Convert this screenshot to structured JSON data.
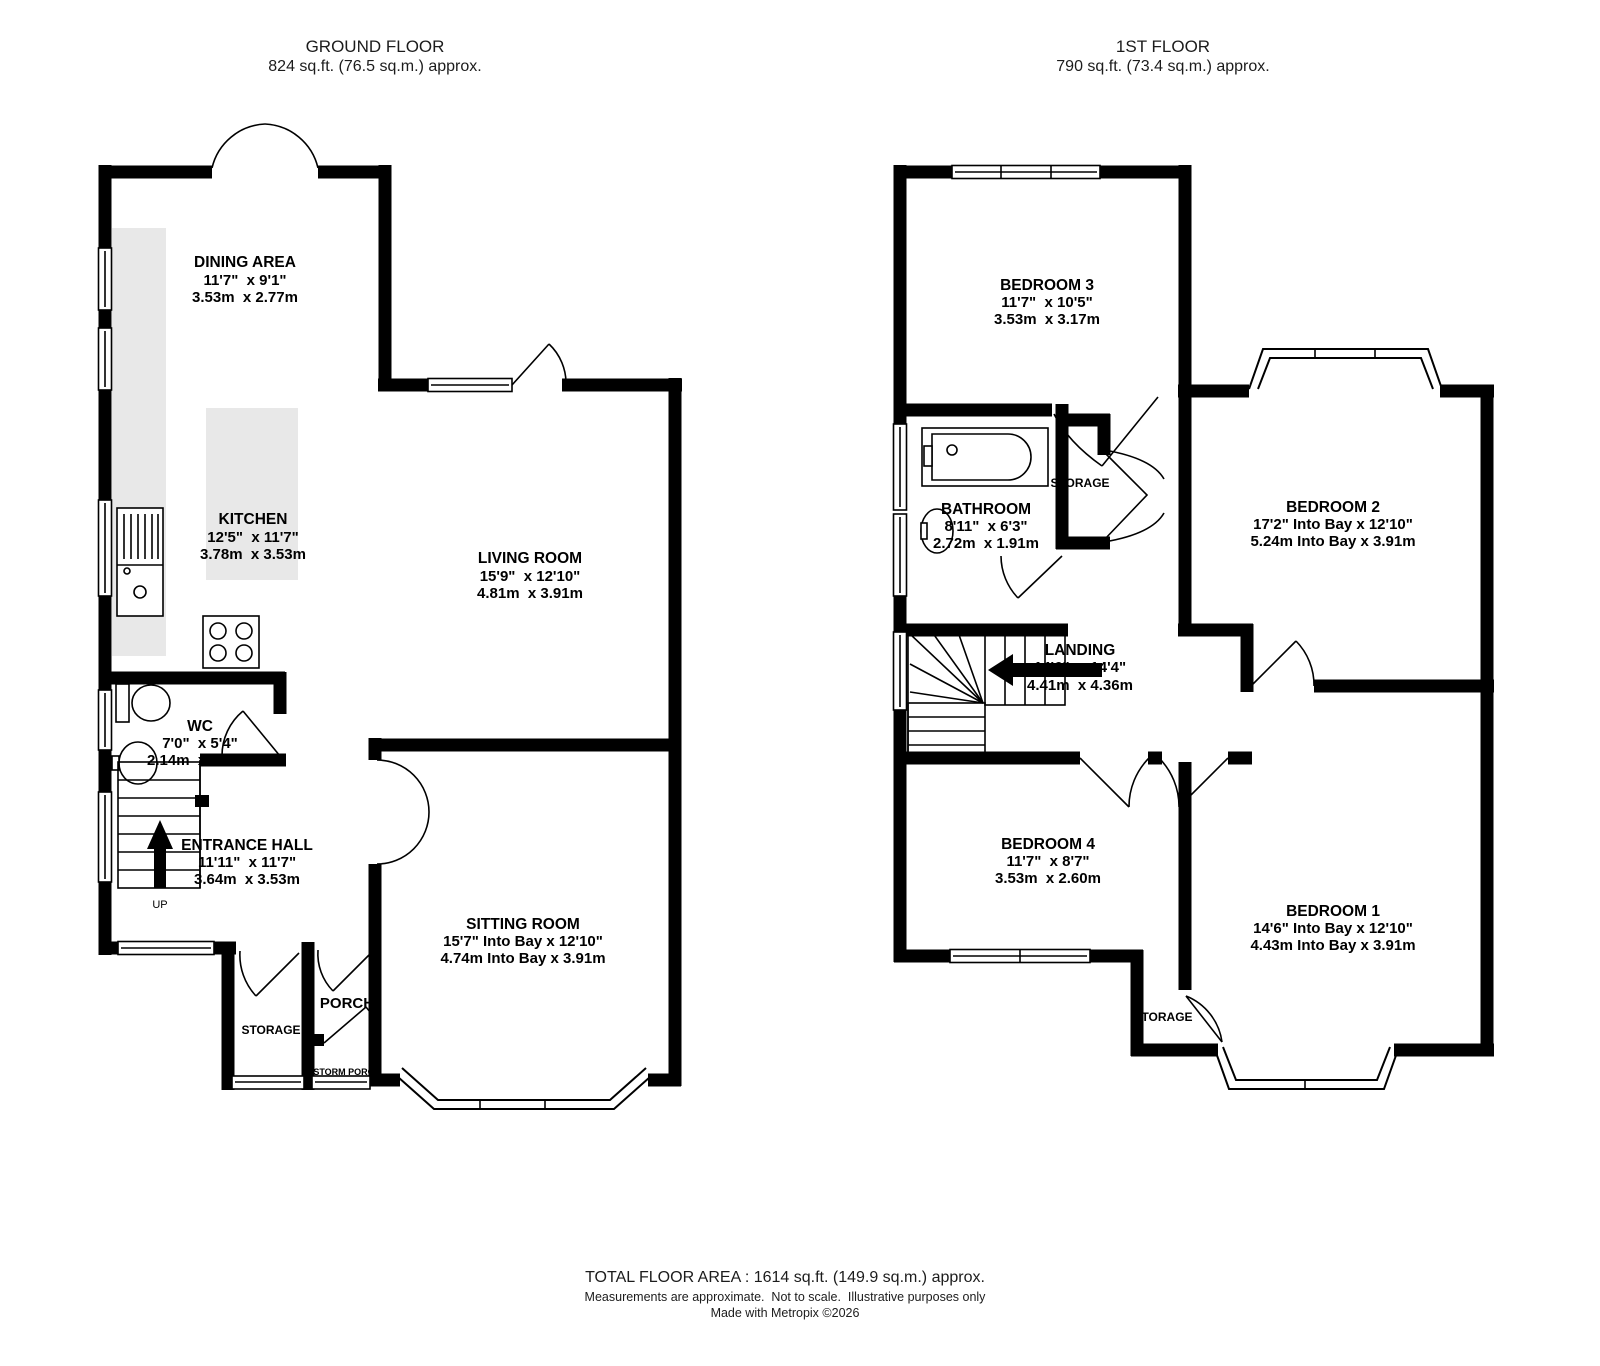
{
  "ground": {
    "title": "GROUND FLOOR",
    "subtitle": "824 sq.ft. (76.5 sq.m.) approx.",
    "rooms": {
      "dining": {
        "name": "DINING AREA",
        "imperial": "11'7\"  x 9'1\"",
        "metric": "3.53m  x 2.77m"
      },
      "kitchen": {
        "name": "KITCHEN",
        "imperial": "12'5\"  x 11'7\"",
        "metric": "3.78m  x 3.53m"
      },
      "living": {
        "name": "LIVING ROOM",
        "imperial": "15'9\"  x 12'10\"",
        "metric": "4.81m  x 3.91m"
      },
      "wc": {
        "name": "WC",
        "imperial": "7'0\"  x 5'4\"",
        "metric": "2.14m  x 1.63m"
      },
      "hall": {
        "name": "ENTRANCE HALL",
        "imperial": "11'11\"  x 11'7\"",
        "metric": "3.64m  x 3.53m"
      },
      "sitting": {
        "name": "SITTING ROOM",
        "imperial": "15'7\" Into Bay x 12'10\"",
        "metric": "4.74m Into Bay x 3.91m"
      }
    },
    "labels": {
      "storage": "STORAGE",
      "porch": "PORCH",
      "storm_porch": "STORM PORCH",
      "up": "UP"
    }
  },
  "first": {
    "title": "1ST FLOOR",
    "subtitle": "790 sq.ft. (73.4 sq.m.) approx.",
    "rooms": {
      "bedroom3": {
        "name": "BEDROOM 3",
        "imperial": "11'7\"  x 10'5\"",
        "metric": "3.53m  x 3.17m"
      },
      "bathroom": {
        "name": "BATHROOM",
        "imperial": "8'11\"  x 6'3\"",
        "metric": "2.72m  x 1.91m"
      },
      "bedroom2": {
        "name": "BEDROOM 2",
        "imperial": "17'2\" Into Bay x 12'10\"",
        "metric": "5.24m Into Bay x 3.91m"
      },
      "landing": {
        "name": "LANDING",
        "imperial": "14'6\"  x 14'4\"",
        "metric": "4.41m  x 4.36m"
      },
      "bedroom4": {
        "name": "BEDROOM 4",
        "imperial": "11'7\"  x 8'7\"",
        "metric": "3.53m  x 2.60m"
      },
      "bedroom1": {
        "name": "BEDROOM 1",
        "imperial": "14'6\" Into Bay x 12'10\"",
        "metric": "4.43m Into Bay x 3.91m"
      }
    },
    "labels": {
      "storage_top": "STORAGE",
      "storage_bottom": "STORAGE",
      "down": "DOWN"
    }
  },
  "footer": {
    "total": "TOTAL FLOOR AREA : 1614 sq.ft. (149.9 sq.m.) approx.",
    "disclaimer": "Measurements are approximate.  Not to scale.  Illustrative purposes only",
    "credit": "Made with Metropix ©2026"
  },
  "colors": {
    "wall": "#000000",
    "counter": "#e8e8e8",
    "background": "#ffffff"
  }
}
